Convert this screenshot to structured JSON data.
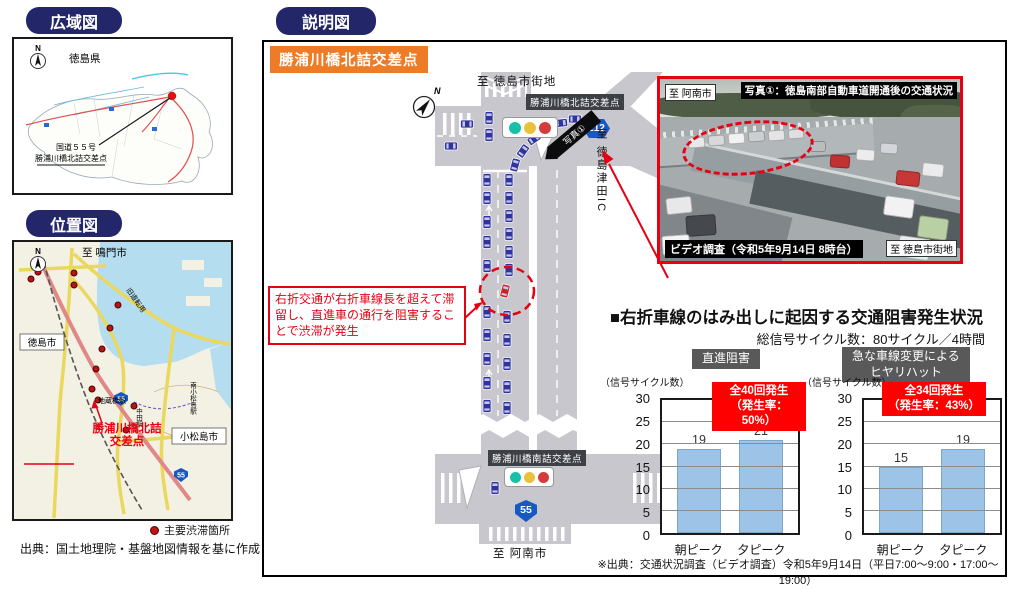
{
  "wide_map": {
    "title": "広域図",
    "compass": "N",
    "prefecture": "徳島県",
    "callout_line1": "国道５５号",
    "callout_line2": "勝浦川橋北詰交差点"
  },
  "location_map": {
    "title": "位置図",
    "compass": "N",
    "to_north": "至 鳴門市",
    "city": "徳島市",
    "station_jizobashi": "地蔵橋駅",
    "old_road": "旧道転用",
    "callout": "勝浦川橋北詰\n交差点",
    "city2": "小松島市",
    "station_nakata": "中田駅",
    "station_minami": "南小松島駅",
    "route55": "55",
    "legend": "主要渋滞箇所",
    "source": "出典：国土地理院・基盤地図情報を基に作成"
  },
  "diagram": {
    "title": "説明図",
    "compass": "N",
    "intersection_badge": "勝浦川橋北詰交差点",
    "to_tokushima": "至 徳島市街地",
    "north_badge": "勝浦川橋北詰交差点",
    "route212": "212",
    "to_tsuda": "至 徳島津田IC",
    "photo_ref": "写真①",
    "annotation": "右折交通が右折車線長を超えて滞留し、直進車の通行を阻害することで渋滞が発生",
    "south_badge": "勝浦川橋南詰交差点",
    "route55": "55",
    "to_anan": "至 阿南市"
  },
  "photo": {
    "caption": "写真①：徳島南部自動車道開通後の交通状況",
    "tag_top_left": "至 阿南市",
    "tag_bottom_left": "ビデオ調査（令和5年9月14日 8時台）",
    "tag_bottom_right": "至 徳島市街地"
  },
  "charts": {
    "section_title": "■右折車線のはみ出しに起因する交通阻害発生状況",
    "subtitle": "総信号サイクル数：80サイクル／4時間",
    "footnote": "※出典：交通状況調査（ビデオ調査）令和5年9月14日（平日7:00～9:00・17:00～19:00）"
  },
  "chart_data": [
    {
      "type": "bar",
      "title": "直進阻害",
      "categories": [
        "朝ピーク",
        "夕ピーク"
      ],
      "values": [
        19,
        21
      ],
      "ylabel": "（信号サイクル数）",
      "ylim": [
        0,
        30
      ],
      "ytick_step": 5,
      "grid": true,
      "legend_position": "none",
      "annotation": "全40回発生\n（発生率：50%）",
      "bar_color": "#9dc3e6"
    },
    {
      "type": "bar",
      "title": "急な車線変更による\nヒヤリハット",
      "categories": [
        "朝ピーク",
        "夕ピーク"
      ],
      "values": [
        15,
        19
      ],
      "ylabel": "（信号サイクル数）",
      "ylim": [
        0,
        30
      ],
      "ytick_step": 5,
      "grid": true,
      "legend_position": "none",
      "annotation": "全34回発生\n（発生率：43%）",
      "bar_color": "#9dc3e6"
    }
  ],
  "colors": {
    "accent_navy": "#23276a",
    "accent_orange": "#ee7b26",
    "alert_red": "#ff0000",
    "bar_blue": "#9dc3e6",
    "road_gray": "#c7c7cd",
    "badge_gray": "#595959"
  }
}
